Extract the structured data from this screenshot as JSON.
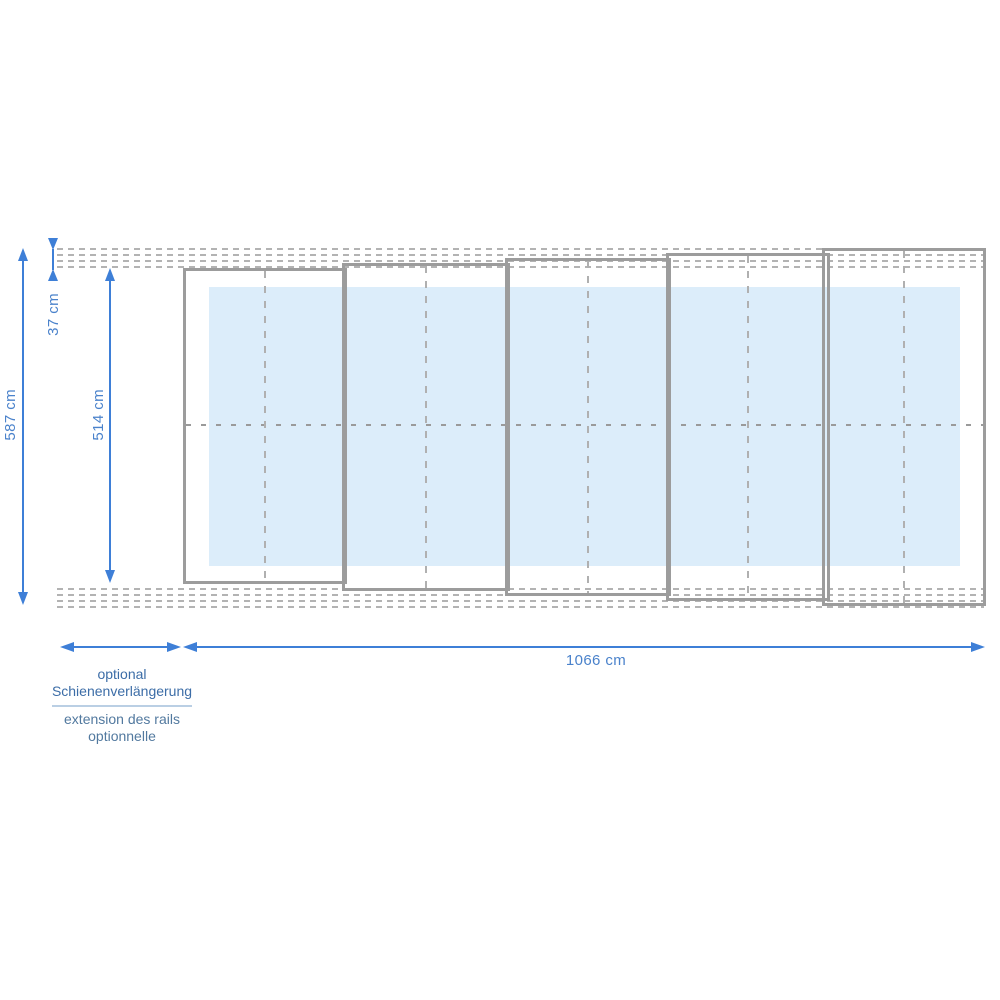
{
  "dimensions": {
    "rail_band": "37 cm",
    "outer_height": "587 cm",
    "inner_height": "514 cm",
    "total_length": "1066 cm"
  },
  "notes": {
    "rail_extension_de_line1": "optional",
    "rail_extension_de_line2": "Schienenverlängerung",
    "rail_extension_fr_line1": "extension des rails",
    "rail_extension_fr_line2": "optionnelle"
  },
  "structure": {
    "segment_count": 5
  },
  "colors": {
    "arrow_blue": "#3e7fd7",
    "dim_label_blue": "#4a82cb",
    "note_de_blue": "#3c6da7",
    "note_fr_blue": "#52799f",
    "note_divider": "#bacfe4",
    "segment_border": "#9c9c9c",
    "rail_dash": "#b3b3b3",
    "center_dash": "#9a9a9a",
    "vcenter_dash": "#b0b0b0",
    "pool_fill": "#dcedfa"
  }
}
